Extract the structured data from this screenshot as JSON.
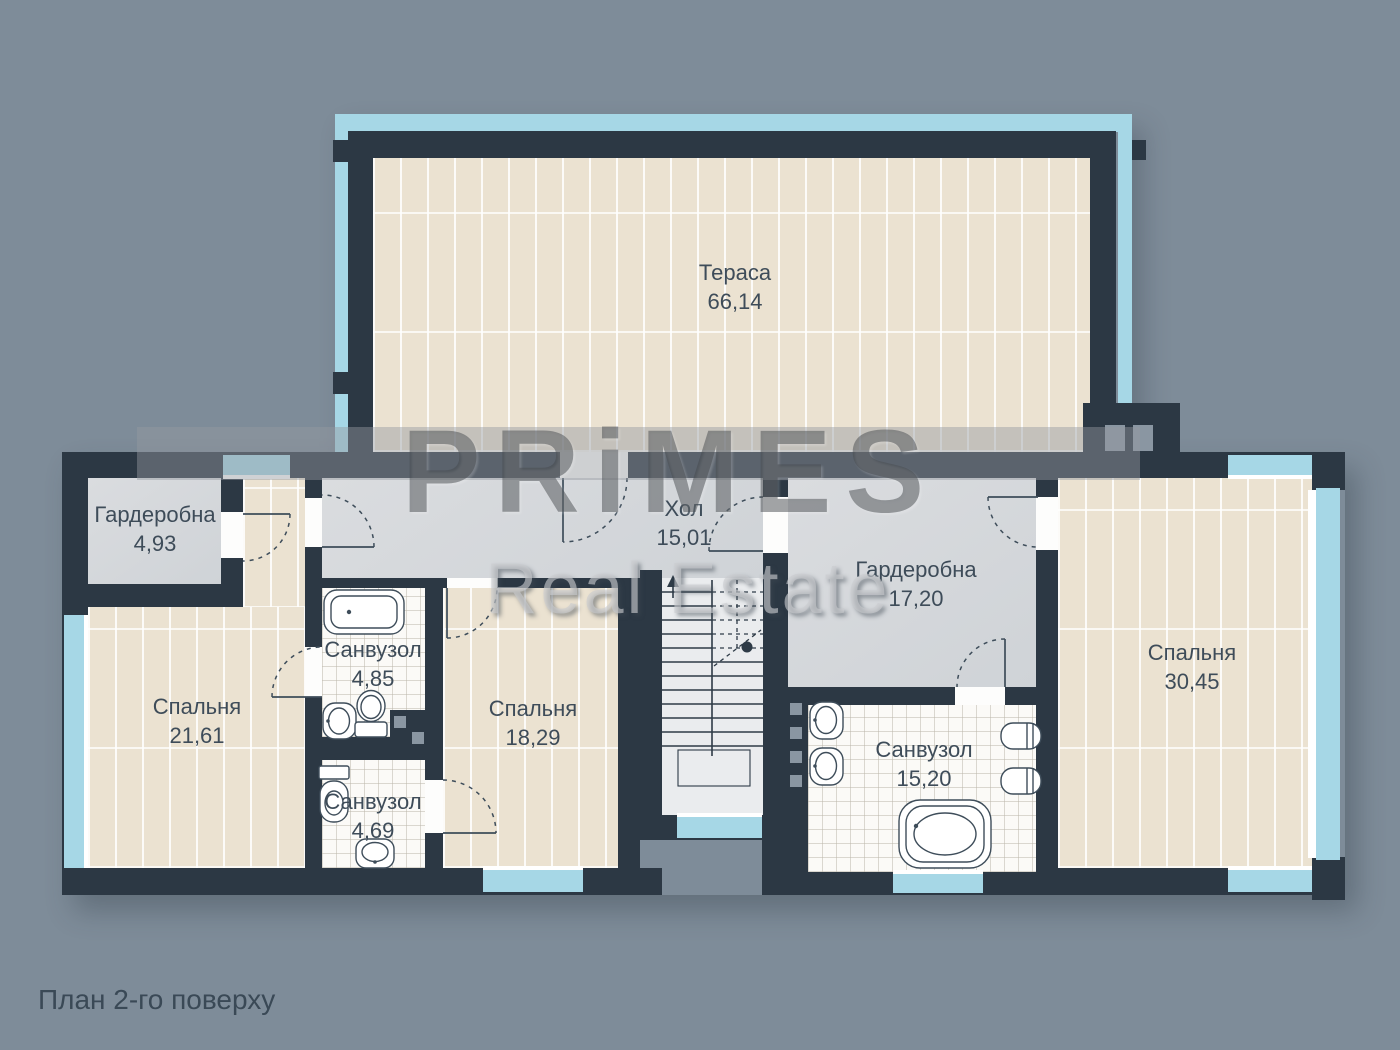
{
  "title": "План 2-го поверху",
  "watermark": {
    "line1": "PRiMES",
    "line2": "Real Estate"
  },
  "colors": {
    "background": "#7e8c99",
    "wall": "#2c3844",
    "window_glass": "#a6d7e6",
    "plank_floor": "#ebe2d1",
    "tile_floor": "#fbfaf7",
    "gray_floor": "#d6d9dc",
    "label_text": "#3e4c59"
  },
  "rooms": {
    "terrace": {
      "name": "Тераса",
      "area": "66,14"
    },
    "wardrobe_small": {
      "name": "Гардеробна",
      "area": "4,93"
    },
    "bedroom_left": {
      "name": "Спальня",
      "area": "21,61"
    },
    "bath_top": {
      "name": "Санвузол",
      "area": "4,85"
    },
    "bath_bottom": {
      "name": "Санвузол",
      "area": "4,69"
    },
    "bedroom_mid": {
      "name": "Спальня",
      "area": "18,29"
    },
    "hall": {
      "name": "Хол",
      "area": "15,01"
    },
    "wardrobe_big": {
      "name": "Гардеробна",
      "area": "17,20"
    },
    "bath_big": {
      "name": "Санвузол",
      "area": "15,20"
    },
    "bedroom_right": {
      "name": "Спальня",
      "area": "30,45"
    }
  }
}
